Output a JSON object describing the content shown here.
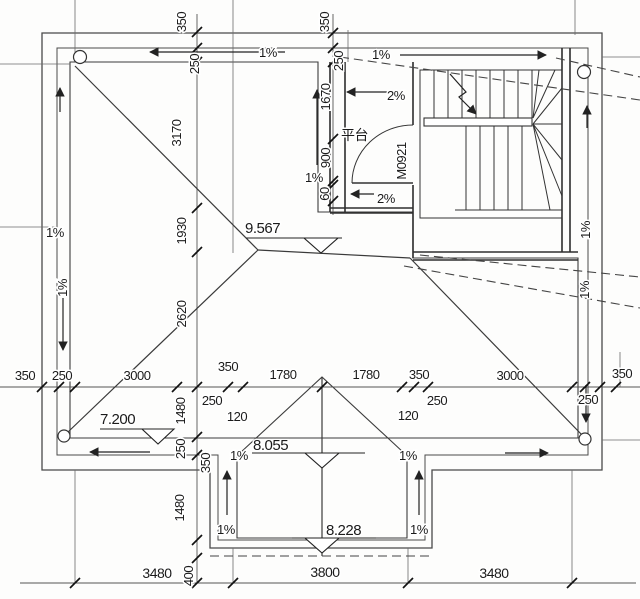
{
  "drawing": {
    "elevations": {
      "main_ridge": "9.567",
      "left_eave": "7.200",
      "bay_eave": "8.055",
      "bay_ridge": "8.228"
    },
    "slopes": {
      "one": "1%",
      "two": "2%"
    },
    "rooms": {
      "platform": "平台"
    },
    "doors": {
      "stair_door": "M0921"
    },
    "dims": {
      "d60": "60",
      "d120": "120",
      "d250": "250",
      "d350": "350",
      "d400": "400",
      "d900": "900",
      "d1480": "1480",
      "d1670": "1670",
      "d1780": "1780",
      "d1930": "1930",
      "d2620": "2620",
      "d3000": "3000",
      "d3170": "3170",
      "d3480": "3480",
      "d3800": "3800"
    }
  }
}
